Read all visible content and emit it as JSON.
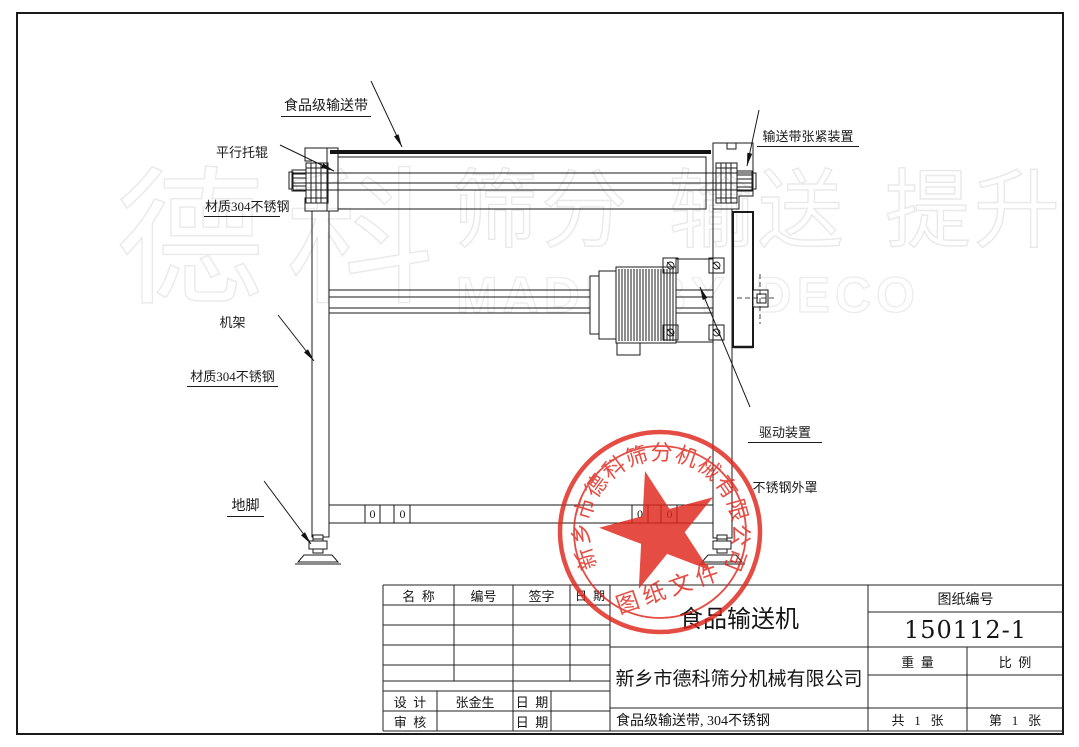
{
  "watermark": {
    "brand": "德科",
    "words": "筛分 输送 提升",
    "latin": "MADE BY DECO"
  },
  "drawing": {
    "labels": {
      "belt": "食品级输送带",
      "roller_line1": "平行托辊",
      "roller_line2": "材质304不锈钢",
      "tensioner": "输送带张紧装置",
      "frame_line1": "机架",
      "frame_line2": "材质304不锈钢",
      "drive_line1": "驱动装置",
      "drive_line2": "不锈钢外罩",
      "foot": "地脚",
      "zero_marks": [
        "0",
        "0",
        "0",
        "0"
      ]
    }
  },
  "stamp": {
    "company_arc": "新乡市德科筛分机械有限公司",
    "doc_type": "图纸文件",
    "color": "#e0251b"
  },
  "title_block": {
    "header": {
      "name": "名  称",
      "number": "编号",
      "signature": "签字",
      "date": "日  期"
    },
    "design_label": "设  计",
    "designer": "张金生",
    "date_label": "日  期",
    "check_label": "审  核",
    "date_label2": "日  期",
    "product": "食品输送机",
    "company": "新乡市德科筛分机械有限公司",
    "spec": "食品级输送带, 304不锈钢",
    "drawing_no_label": "图纸编号",
    "drawing_no": "150112-1",
    "weight_label": "重  量",
    "scale_label": "比  例",
    "total_sheets": "共   1   张",
    "sheet_no": "第   1   张"
  }
}
